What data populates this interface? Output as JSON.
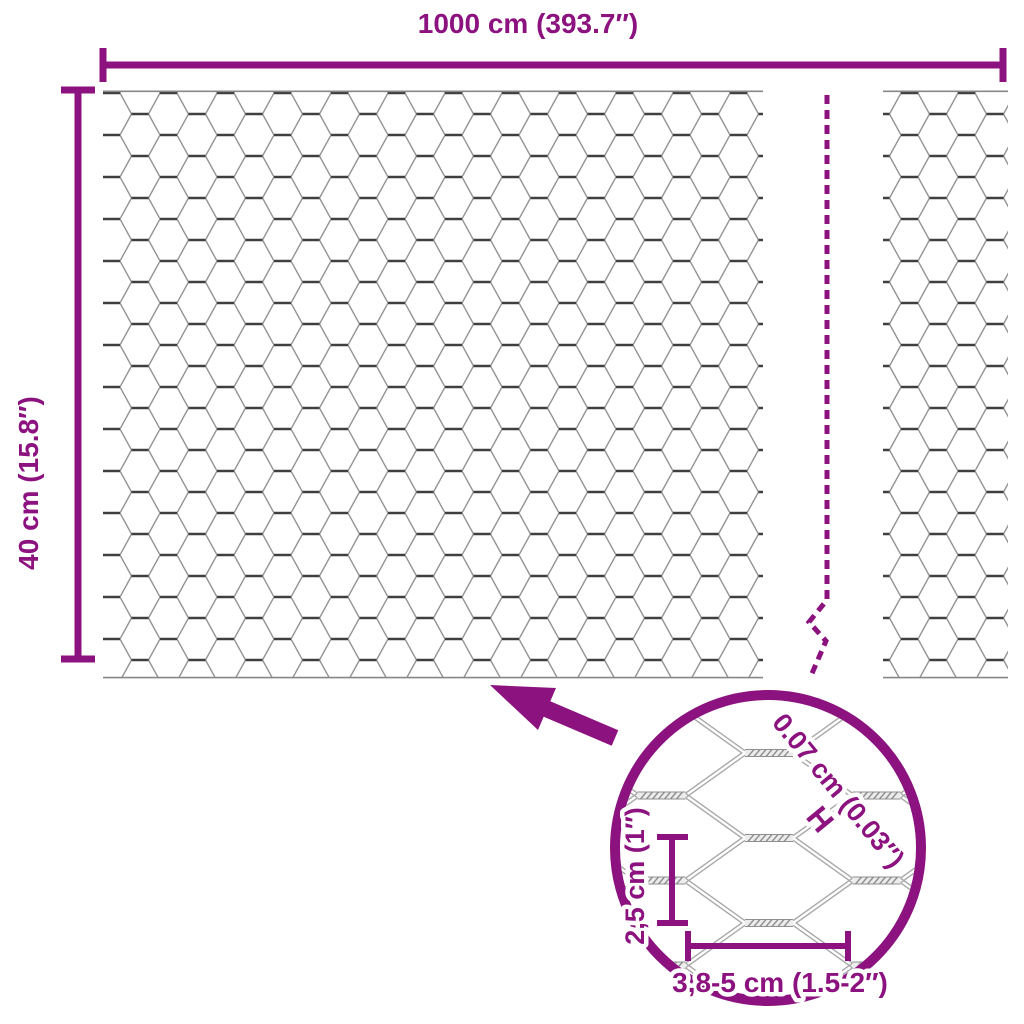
{
  "colors": {
    "accent": "#8C127F",
    "wire_light": "#949494",
    "wire_dark": "#3F3F3F",
    "rope_gray": "#8F8F8F"
  },
  "roll": {
    "width_label": "1000 cm (393.7″)",
    "height_label": "40 cm (15.8″)"
  },
  "detail": {
    "wire_thickness_label": "0.07 cm (0.03″)",
    "wire_thickness_marker": "H",
    "mesh_size_vertical_label": "2,5 cm (1″)",
    "mesh_size_horizontal_label": "3,8-5 cm (1.5-2″)"
  }
}
